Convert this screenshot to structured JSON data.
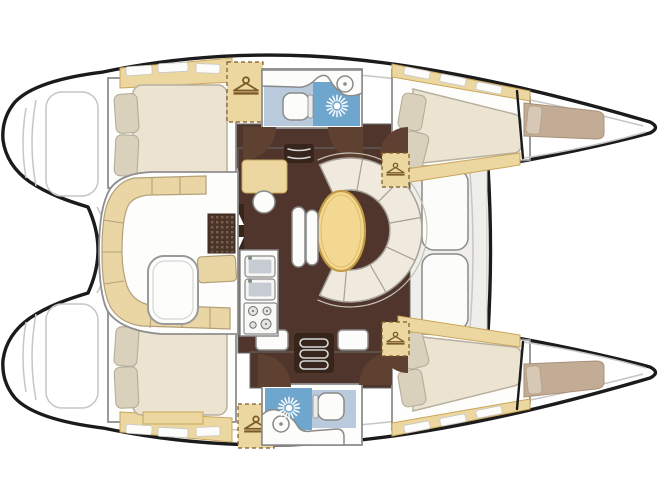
{
  "meta": {
    "description": "Top-down interior layout plan of a four-cabin sailing catamaran",
    "diagram_type": "boat-floor-plan",
    "visible_text": []
  },
  "colors": {
    "background": "#ffffff",
    "outline": "#1b1b1b",
    "line_gray": "#c6c6c6",
    "border_gray": "#8e8e8e",
    "deck_white": "#ffffff",
    "room_white": "#fdfdfb",
    "tan": "#ecd7a0",
    "tan_border": "#c9a55b",
    "hanger_brown": "#7a5a28",
    "cream": "#ece4d1",
    "cream_border": "#b7b0a0",
    "pillow": "#d9d1bc",
    "pillow_border": "#b5ad9b",
    "settee": "#efeadd",
    "settee_border": "#a5a196",
    "table_wood": "#f2d891",
    "table_wood_border": "#c49b45",
    "floor_brown": "#4f352b",
    "steps_dark": "#37251c",
    "door_brown": "#5f4131",
    "grate_dot": "#7a5f4b",
    "bath_blue": "#6fa6ce",
    "bath_blue_light": "#b9cadc",
    "berth_taupe": "#c3ac95",
    "berth_taupe_border": "#a8907a",
    "bench_tan": "#e9d6a4",
    "bench_tan_border": "#b3a079",
    "white_fixture": "#fcfcfa",
    "fixture_border": "#8a8a8a",
    "foredeck": "#efeeea",
    "sink_steel": "#c7ccd2"
  },
  "structure": {
    "hulls": [
      "port",
      "starboard"
    ],
    "cabins": [
      {
        "id": "port-aft-cabin",
        "berth": "double",
        "features": [
          "hanging-locker",
          "pillows",
          "shelf"
        ]
      },
      {
        "id": "port-forward-cabin",
        "berth": "double",
        "features": [
          "hanging-locker",
          "pillows",
          "shelf"
        ]
      },
      {
        "id": "starboard-aft-cabin",
        "berth": "double",
        "features": [
          "hanging-locker",
          "pillows",
          "shelf"
        ]
      },
      {
        "id": "starboard-forward-cabin",
        "berth": "double",
        "features": [
          "hanging-locker",
          "pillows",
          "shelf"
        ]
      }
    ],
    "heads": [
      {
        "id": "port-head",
        "fixtures": [
          "toilet",
          "shower",
          "washbasin"
        ]
      },
      {
        "id": "starboard-head",
        "fixtures": [
          "toilet",
          "shower",
          "washbasin"
        ]
      }
    ],
    "bow_berths": [
      "port-bow-berth",
      "starboard-bow-berth"
    ],
    "salon": {
      "fixtures": [
        "chart-table",
        "stool",
        "galley-sinks",
        "stove",
        "dinette-table",
        "curved-settee",
        "bench",
        "companionway-steps"
      ]
    },
    "cockpit": {
      "fixtures": [
        "bench-seating",
        "table",
        "teak-grate"
      ]
    }
  },
  "icons": [
    "hanger-icon",
    "shower-sunburst-icon",
    "toilet-icon",
    "washbasin-icon",
    "stove-burner-icon",
    "steps-icon",
    "door-swing-icon",
    "arrow-icon"
  ]
}
